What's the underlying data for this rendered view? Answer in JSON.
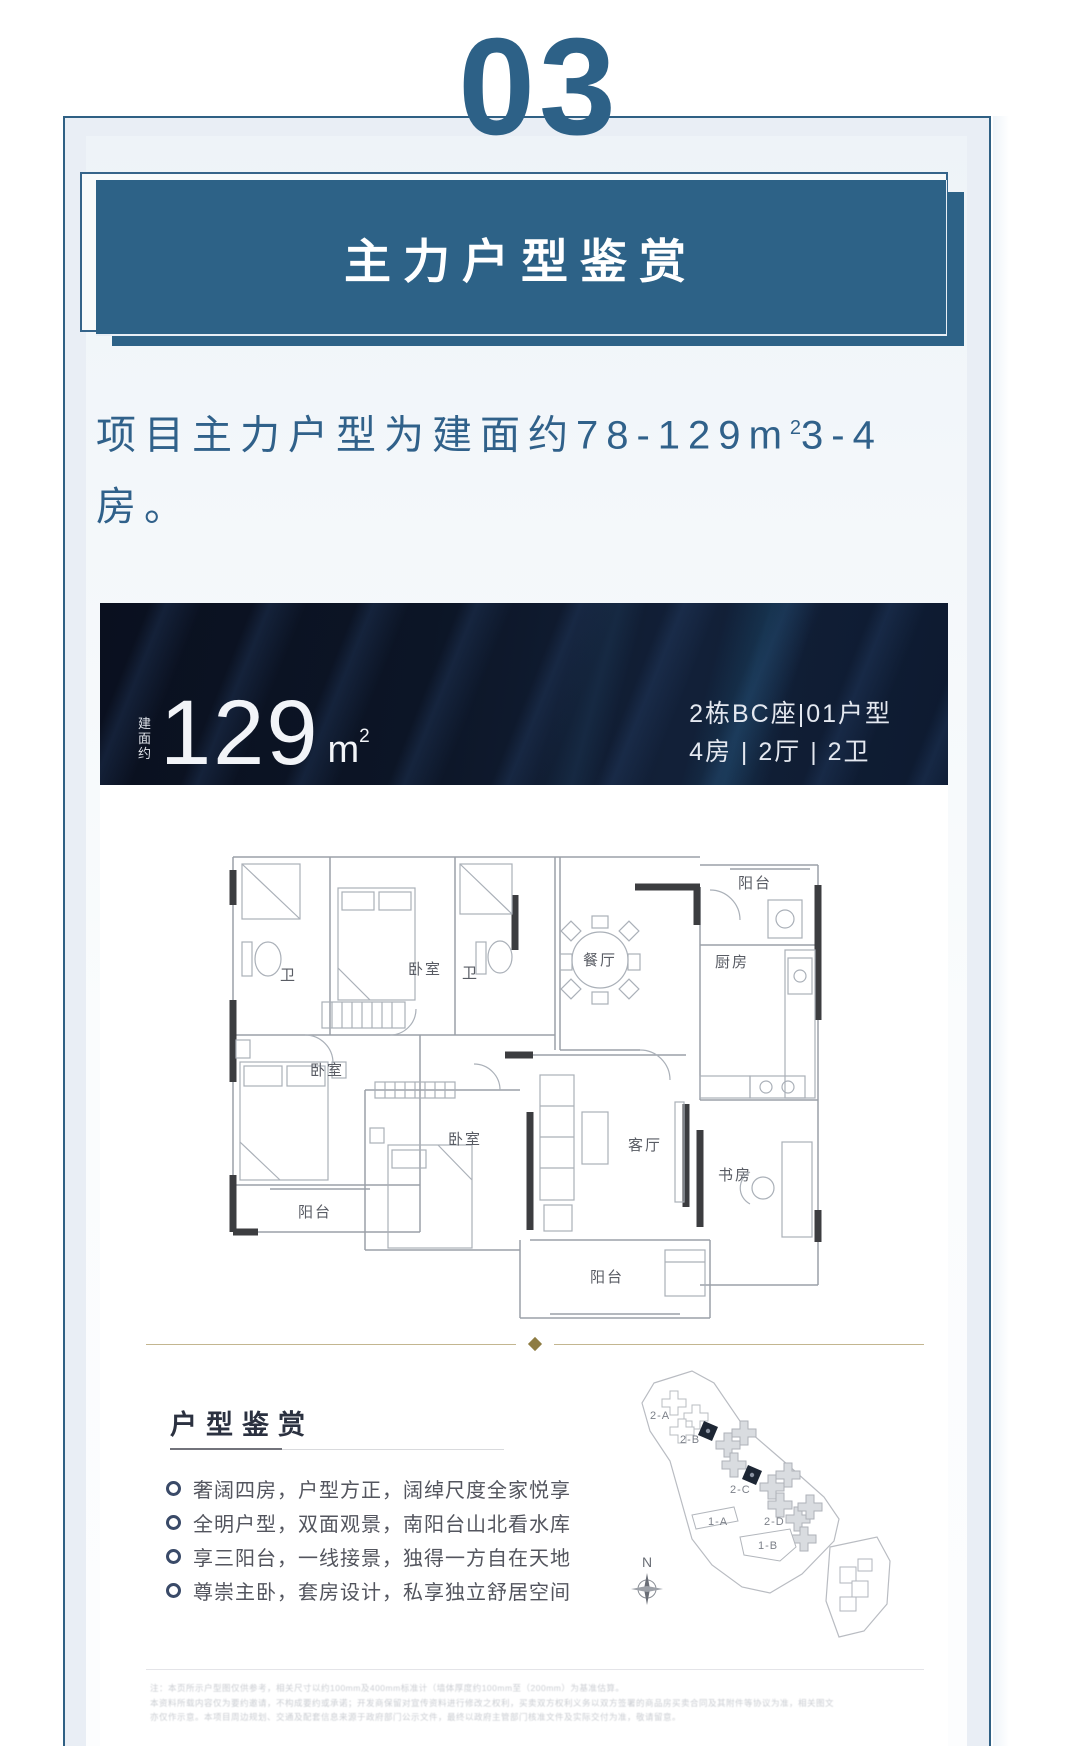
{
  "page": {
    "section_number": "03"
  },
  "title_banner": {
    "text": "主力户型鉴赏"
  },
  "intro": {
    "line1_pre": "项目主力户型为建面约78-129",
    "unit": "m",
    "unit_sup": "2",
    "line1_post": "3-4",
    "line2": "房。"
  },
  "unit_banner": {
    "area_label": "建面约",
    "area_value": "129",
    "area_unit": "m",
    "area_unit_sup": "2",
    "block_info": "2栋BC座|01户型",
    "layout_info": "4房 | 2厅 | 2卫"
  },
  "floor_plan": {
    "rooms": {
      "bath1": "卫",
      "bedroom_top": "卧室",
      "bath2": "卫",
      "dining": "餐厅",
      "balcony_top": "阳台",
      "kitchen": "厨房",
      "bedroom_left": "卧室",
      "bedroom_mid": "卧室",
      "living": "客厅",
      "study": "书房",
      "balcony_left": "阳台",
      "balcony_bottom": "阳台"
    }
  },
  "highlights": {
    "heading": "户型鉴赏",
    "bullets": [
      "奢阔四房，户型方正，阔绰尺度全家悦享",
      "全明户型，双面观景，南阳台山北看水库",
      "享三阳台，一线接景，独得一方自在天地",
      "尊崇主卧，套房设计，私享独立舒居空间"
    ]
  },
  "site_plan": {
    "labels": {
      "a": "2-A",
      "b": "2-B",
      "c": "2-C",
      "d": "2-D",
      "e": "1-A",
      "f": "1-B"
    },
    "compass_n": "N"
  },
  "disclaimer": {
    "lines": [
      "注：本页所示户型图仅供参考，相关尺寸以约100mm及400mm标准计（墙体厚度约100mm至（200mm）为基准估算。",
      "本资料所载内容仅为要约邀请，不构成要约或承诺；开发商保留对宣传资料进行修改之权利，买卖双方权利义务以双方签署的商品房买卖合同及其附件等协议为准，相关图文",
      "亦仅作示意。本项目周边规划、交通及配套信息来源于政府部门公示文件，最终以政府主管部门核准文件及实际交付为准，敬请留意。"
    ]
  },
  "colors": {
    "accent": "#2d6287",
    "banner_dark": "#0b1322",
    "gold": "#8e7c42"
  }
}
